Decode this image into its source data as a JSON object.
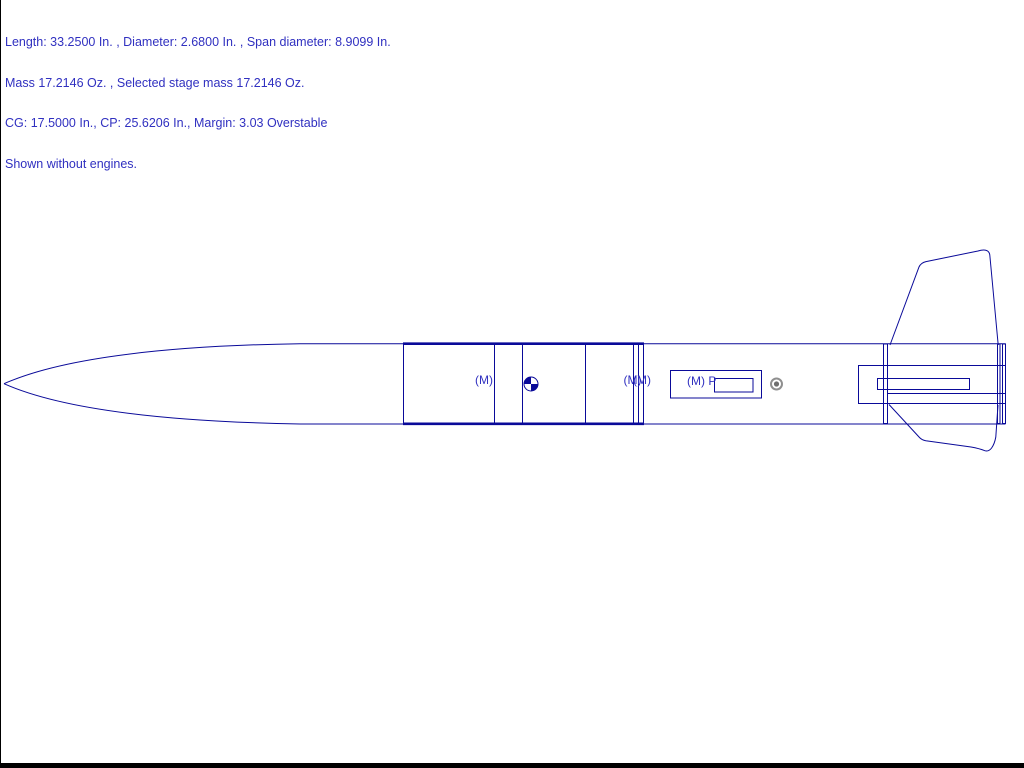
{
  "colors": {
    "background": "#ffffff",
    "line": "#0a0a99",
    "text-blue": "#3030c0",
    "cp-gray": "#8f8f8f",
    "cp-gray-dark": "#6f6f6f",
    "border-black": "#000000"
  },
  "info_panel": {
    "lines": [
      "Length: 33.2500 In. , Diameter: 2.6800 In. , Span diameter: 8.9099 In.",
      "Mass 17.2146 Oz. , Selected stage mass 17.2146 Oz.",
      "CG: 17.5000 In., CP: 25.6206 In., Margin: 3.03 Overstable",
      "Shown without engines."
    ],
    "values": {
      "length_in": 33.25,
      "diameter_in": 2.68,
      "span_diameter_in": 8.9099,
      "mass_oz": 17.2146,
      "selected_stage_mass_oz": 17.2146,
      "cg_in": 17.5,
      "cp_in": 25.6206,
      "margin": 3.03,
      "stability": "Overstable",
      "engines_note": "Shown without engines."
    }
  },
  "diagram": {
    "labels": {
      "mass_marker_1": "(M)",
      "mass_marker_2": "(M)",
      "mass_marker_3": "(M)",
      "parachute_label": "(M) P"
    }
  }
}
